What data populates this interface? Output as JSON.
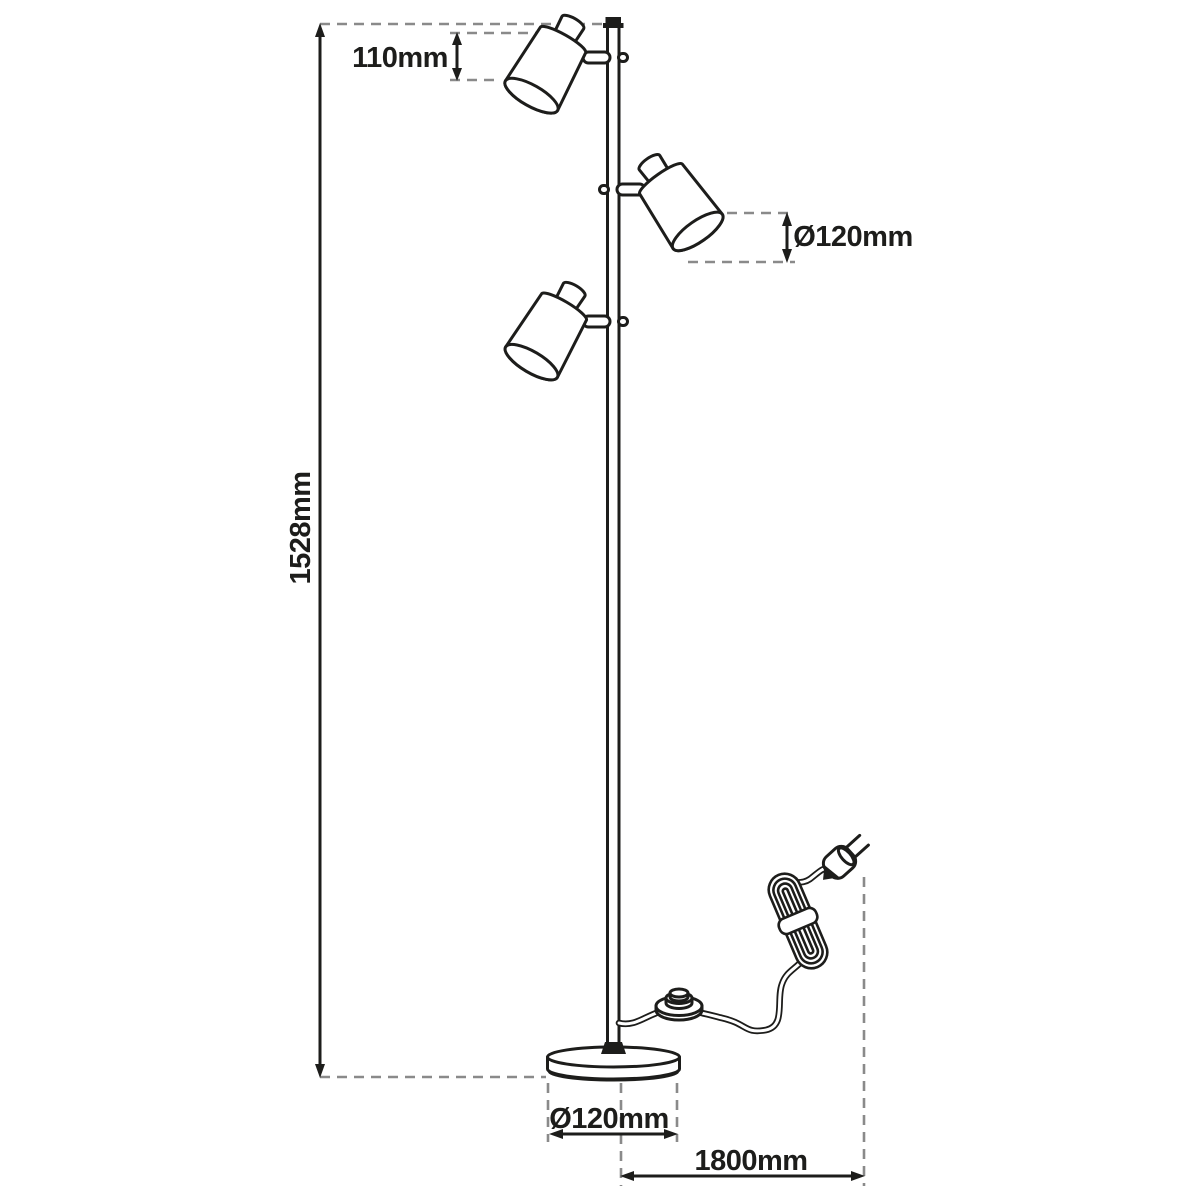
{
  "diagram": {
    "kind": "floor-lamp-dimension-drawing",
    "background": "#ffffff",
    "line_color": "#1d1d1b",
    "guide_color": "#8a8a8a",
    "dimensions": {
      "shade_height": "110mm",
      "shade_diameter": "Ø120mm",
      "total_height": "1528mm",
      "base_diameter": "Ø120mm",
      "cable_length": "1800mm"
    }
  }
}
